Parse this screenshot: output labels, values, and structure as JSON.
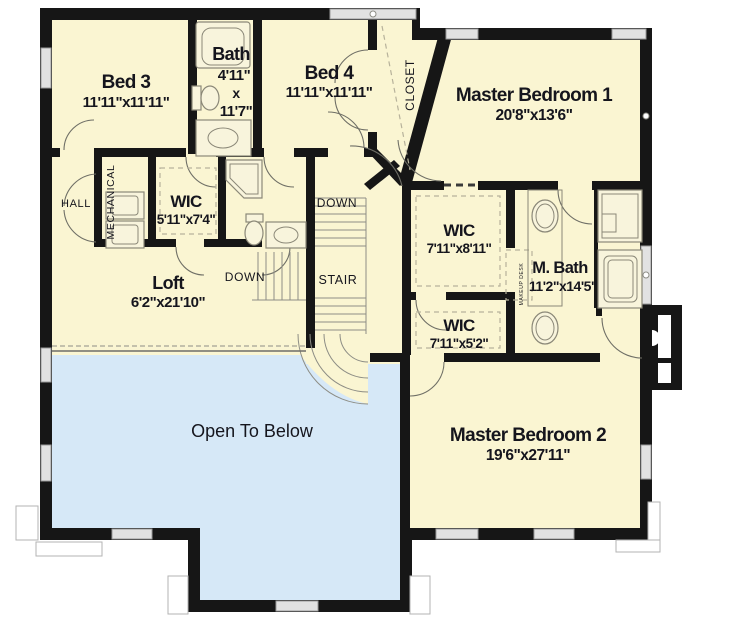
{
  "plan": {
    "rooms": {
      "bed3": {
        "name": "Bed 3",
        "dims": "11'11\"x11'11\""
      },
      "bath": {
        "name": "Bath",
        "dim_w": "4'11\"",
        "dim_sep": "x",
        "dim_h": "11'7\""
      },
      "bed4": {
        "name": "Bed 4",
        "dims": "11'11\"x11'11\""
      },
      "master1": {
        "name": "Master Bedroom 1",
        "dims": "20'8\"x13'6\""
      },
      "wic_hall": {
        "name": "WIC",
        "dims": "5'11\"x7'4\""
      },
      "loft": {
        "name": "Loft",
        "dims": "6'2\"x21'10\""
      },
      "wic1": {
        "name": "WIC",
        "dims": "7'11\"x8'11\""
      },
      "wic2": {
        "name": "WIC",
        "dims": "7'11\"x5'2\""
      },
      "mbath": {
        "name": "M. Bath",
        "dims": "11'2\"x14'5\""
      },
      "master2": {
        "name": "Master Bedroom 2",
        "dims": "19'6\"x27'11\""
      },
      "open_below": {
        "name": "Open To Below"
      }
    },
    "labels": {
      "hall": "HALL",
      "mechanical": "MECHANICAL",
      "closet": "CLOSET",
      "stair": "STAIR",
      "down_top": "DOWN",
      "down_left": "DOWN",
      "makeup_desk": "MAKEUP DESK"
    },
    "colors": {
      "floor": "#faf5d2",
      "open_below": "#d6e8f7",
      "wall": "#161616",
      "window": "#e2e2e2",
      "fixture_line": "#8b8878",
      "text": "#15151d"
    }
  }
}
